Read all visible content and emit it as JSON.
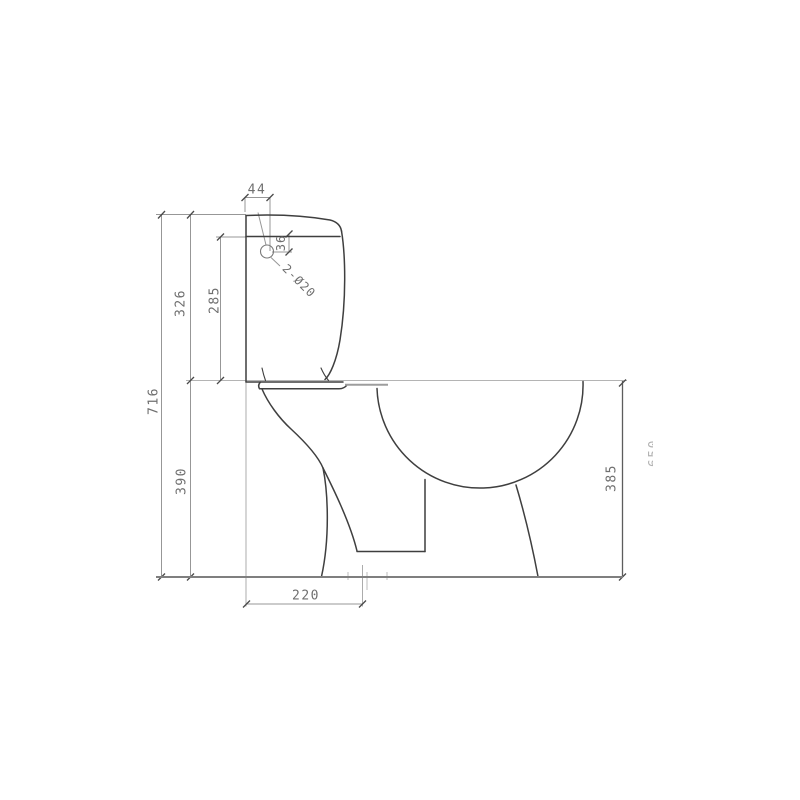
{
  "drawing": {
    "kind": "CAD technical drawing",
    "subject": "toilet side elevation with dimensions",
    "background": "#ffffff",
    "colors": {
      "object_line": "#3f3f3f",
      "dimension_line": "#8f8f8f",
      "ground_line": "#808080",
      "text": "#6f6f6f",
      "faint_text": "#b3b3b3"
    },
    "dims": {
      "overall_height": "716",
      "tank_height": "326",
      "tank_body_height": "285",
      "bowl_front_height": "390",
      "bowl_rear_height": "385",
      "hole_offset_x": "44",
      "hole_offset_y": "36",
      "trap_setback": "220",
      "inlet_holes": "2-Ø20",
      "faint_partial": "650"
    }
  }
}
